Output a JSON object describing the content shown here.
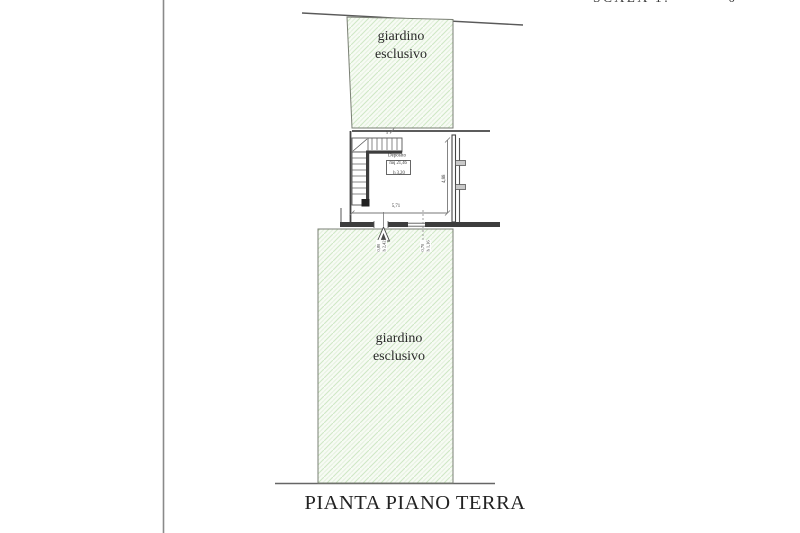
{
  "title": "PIANTA PIANO TERRA",
  "cropped_header": {
    "left": "SCALA 1:",
    "right": "0"
  },
  "gardens": {
    "top": {
      "line1": "giardino",
      "line2": "esclusivo"
    },
    "bottom": {
      "line1": "giardino",
      "line2": "esclusivo"
    }
  },
  "room": {
    "name": "Deposito",
    "area": "mq 21,46",
    "height": "h 3,20"
  },
  "dims": {
    "room_width": "5,71",
    "room_depth": "4,88",
    "top_tick": "5",
    "door_w": "0,80",
    "door_h": "h 2,42",
    "win_w": "0,70",
    "win_h": "h 1,16"
  },
  "colors": {
    "hatch_bg": "#f7fbf4",
    "hatch_line": "#cfe8c6",
    "hatch_line_soft": "#e4f2de",
    "thin_line": "#555555",
    "wall": "#3d3d3d",
    "border": "#7a7f74"
  }
}
